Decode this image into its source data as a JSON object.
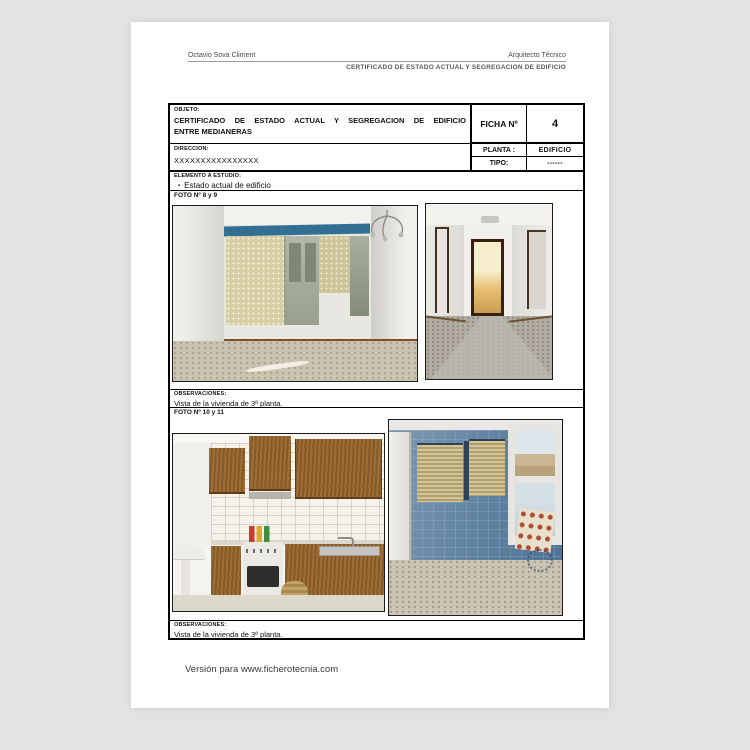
{
  "header": {
    "author": "Octavio Sova Climent",
    "role": "Arquitecto Técnico",
    "doc_title": "CERTIFICADO DE ESTADO ACTUAL Y SEGREGACION DE EDIFICIO"
  },
  "table": {
    "objeto_label": "OBJETO:",
    "objeto_line1": "CERTIFICADO DE ESTADO ACTUAL Y SEGREGACION DE EDIFICIO",
    "objeto_line2": "ENTRE MEDIANERAS",
    "ficha_label": "FICHA Nº",
    "ficha_value": "4",
    "direccion_label": "DIRECCION:",
    "direccion_value": "XXXXXXXXXXXXXXXX",
    "planta_label": "PLANTA :",
    "planta_value": "EDIFICIO",
    "tipo_label": "TIPO:",
    "tipo_value": "------",
    "elemento_label": "ELEMENTO A ESTUDIO:",
    "elemento_bullet": "▪",
    "elemento_value": "Estado actual de edificio",
    "foto89_label": "FOTO Nº 8 y 9",
    "obs1_label": "OBSERVACIONES:",
    "obs1_value": "Vista de la vivienda de 3ª planta.",
    "foto1011_label": "FOTO Nº 10 y 11",
    "obs2_label": "OBSERVACIONES:",
    "obs2_value": "Vista de la vivienda de 3ª planta."
  },
  "photos": {
    "photo_8": "Salón vacío con ventanal y persianas",
    "photo_9": "Pasillo de la vivienda",
    "photo_10": "Cocina con muebles de madera",
    "photo_11": "Galería con azulejos azules"
  },
  "footer": {
    "text": "Versión para www.ficherotecnia.com"
  },
  "colors": {
    "background": "#e5e3e1",
    "paper": "#ffffff",
    "border": "#000000",
    "window_bar_blue": "#336f93",
    "blue_tile": "#5e81a3",
    "cabinet_wood": "#96672f"
  }
}
